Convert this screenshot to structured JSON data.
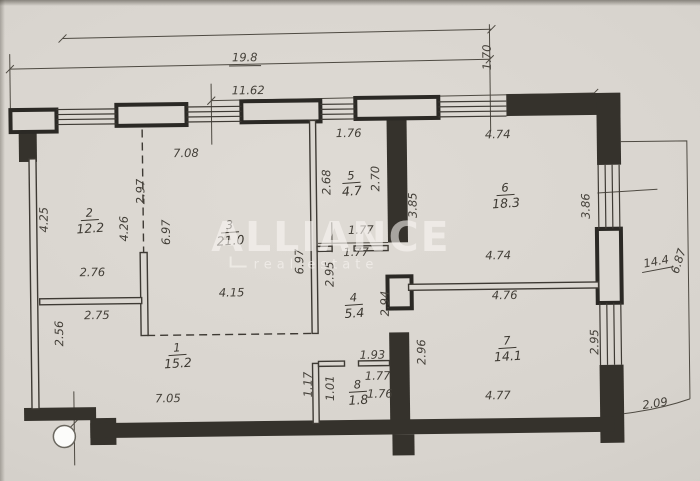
{
  "watermark": {
    "brand": "ALLIANCE",
    "tagline": "real estate"
  },
  "rooms": [
    {
      "number": "1",
      "area": "15.2"
    },
    {
      "number": "2",
      "area": "12.2"
    },
    {
      "number": "3",
      "area": "21.0"
    },
    {
      "number": "4",
      "area": "5.4"
    },
    {
      "number": "5",
      "area": "4.7"
    },
    {
      "number": "6",
      "area": "18.3"
    },
    {
      "number": "7",
      "area": "14.1"
    },
    {
      "number": "8",
      "area": "1.8"
    }
  ],
  "dimensions": {
    "d19_8": "19.8",
    "d11_62": "11.62",
    "d1_70": "1.70",
    "d7_08": "7.08",
    "d2_97": "2.97",
    "d1_76_top": "1.76",
    "d4_25": "4.25",
    "d4_26": "4.26",
    "d6_97_a": "6.97",
    "d2_68": "2.68",
    "d2_70": "2.70",
    "d3_85": "3.85",
    "d4_74_top": "4.74",
    "d3_86": "3.86",
    "d1_77_a": "1.77",
    "d1_77_b": "1.77",
    "d6_97_b": "6.97",
    "d2_95_a": "2.95",
    "d2_94": "2.94",
    "d2_76": "2.76",
    "d2_75": "2.75",
    "d4_15": "4.15",
    "d4_74_bot": "4.74",
    "d4_76": "4.76",
    "d2_56": "2.56",
    "d2_96": "2.96",
    "d2_95_b": "2.95",
    "d14_4": "14.4",
    "d6_87": "6.87",
    "d1_93": "1.93",
    "d1_77_c": "1.77",
    "d1_76_b": "1.76",
    "d1_01": "1.01",
    "d1_17": "1.17",
    "d7_05": "7.05",
    "d4_77": "4.77",
    "d2_09": "2.09"
  }
}
